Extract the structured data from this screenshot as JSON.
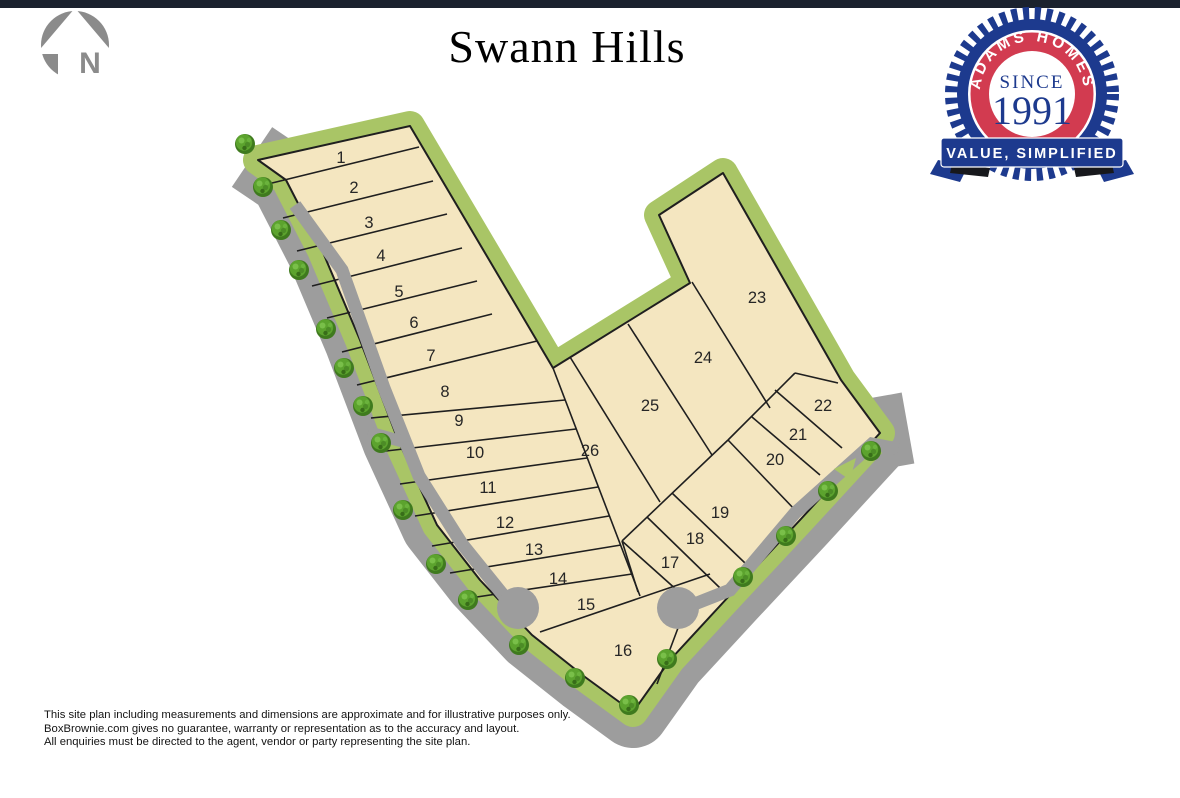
{
  "header": {
    "title": "Swann Hills"
  },
  "north_arrow": {
    "label": "N"
  },
  "badge": {
    "arc_text": "ADAMS HOMES",
    "since_label": "SINCE",
    "year": "1991",
    "banner_text": "VALUE, SIMPLIFIED"
  },
  "site_plan": {
    "name": "Swann Hills",
    "lot_count": 26,
    "lot_numbers": [
      "1",
      "2",
      "3",
      "4",
      "5",
      "6",
      "7",
      "8",
      "9",
      "10",
      "11",
      "12",
      "13",
      "14",
      "15",
      "16",
      "17",
      "18",
      "19",
      "20",
      "21",
      "22",
      "23",
      "24",
      "25",
      "26"
    ]
  },
  "disclaimer": {
    "line1": "This site plan including measurements and dimensions are approximate and for illustrative purposes only.",
    "line2": "BoxBrownie.com gives no guarantee, warranty or representation as to the accuracy and layout.",
    "line3": "All enquiries must be directed to the agent, vendor or party representing the site plan."
  },
  "colors": {
    "parcel": "#f4e6c0",
    "greenbelt": "#a9c566",
    "road": "#9d9d9d",
    "tree": "#4f8f27",
    "badge_blue": "#1d3a8e",
    "badge_red": "#d23b50",
    "topbar": "#1b222e"
  }
}
